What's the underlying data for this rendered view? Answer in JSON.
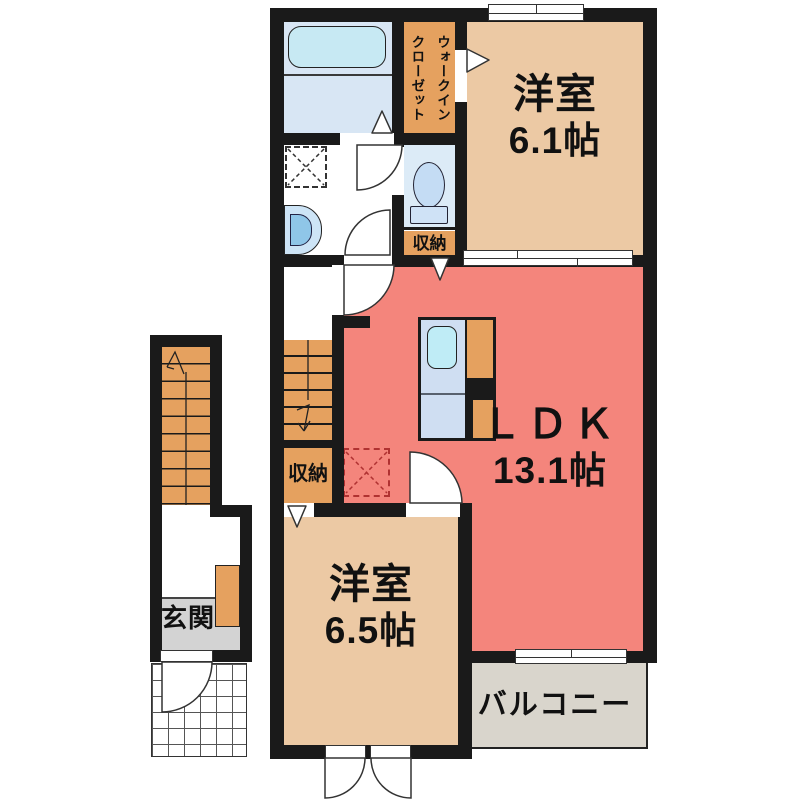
{
  "plan_title": "2LDK floor plan",
  "rooms": {
    "western_room_1": {
      "label": "洋室",
      "size": "6.1帖"
    },
    "ldk": {
      "label": "ＬＤＫ",
      "size": "13.1帖"
    },
    "western_room_2": {
      "label": "洋室",
      "size": "6.5帖"
    },
    "balcony": {
      "label": "バルコニー"
    },
    "entrance": {
      "label": "玄関"
    },
    "walk_in_closet": {
      "line1": "ウォークイン",
      "line2": "クローゼット"
    },
    "storage_upper": {
      "label": "収納"
    },
    "storage_lower": {
      "label": "収納"
    }
  },
  "colors": {
    "wall": "#1a1a1a",
    "western_room": "#ecc9a4",
    "ldk": "#f4857c",
    "closet_orange": "#e5a15f",
    "bath_floor": "#d8e6f4",
    "toilet_floor": "#dcebf7",
    "fixture_blue": "#c7e9f3",
    "entrance_floor": "#d3d3d3",
    "balcony_floor": "#d9d5cc",
    "refrigerator_marker": "#b03232"
  }
}
